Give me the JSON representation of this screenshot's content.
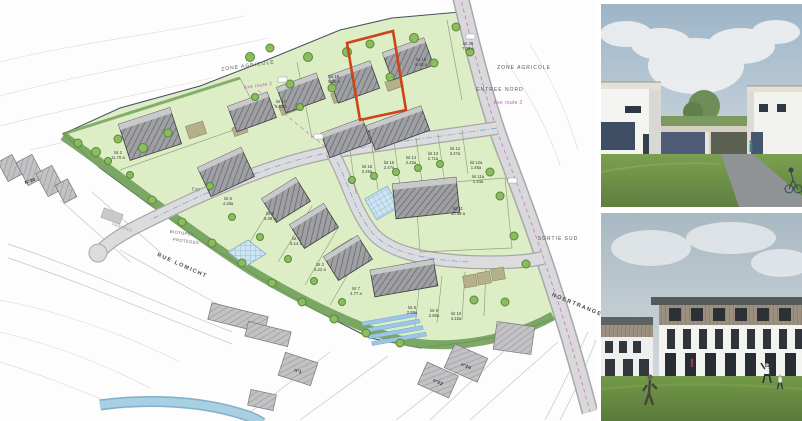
{
  "page": {
    "title": "Plan de lotissement et vues 3D"
  },
  "plan": {
    "texts": {
      "zone_agricole_left": "ZONE AGRICOLE",
      "zone_agricole_right": "ZONE AGRICOLE",
      "entree_nord": "ENTREE NORD",
      "sortie_sud": "SORTIE SUD",
      "axe_route_2": "Axe route 2",
      "axe_route_3": "Axe route 3",
      "rue_lomicht": "RUE LOMICHT",
      "noertrange": "NOERTRANGE>",
      "biotopes_1": "BIOTOPES",
      "biotopes_2": "PROTEGES",
      "parking": "PARKING",
      "esp": "Esp",
      "n30": "N°30",
      "n22": "n°22",
      "n24": "n°24",
      "n1": "n°1"
    },
    "lots": [
      {
        "name": "lot 20",
        "area": "7.02 a"
      },
      {
        "name": "lot 19",
        "area": "6.45 a"
      },
      {
        "name": "lot 18",
        "area": "5.40 a"
      },
      {
        "name": "lot 17",
        "area": "5.63 a"
      },
      {
        "name": "lot 16",
        "area": "2.46a"
      },
      {
        "name": "lot 15",
        "area": "2.47a"
      },
      {
        "name": "lot 14",
        "area": "2.42a"
      },
      {
        "name": "lot 13",
        "area": "2.71a"
      },
      {
        "name": "lot 12",
        "area": "3.47a"
      },
      {
        "name": "lot 12a",
        "area": "1.46a"
      },
      {
        "name": "lot 11a",
        "area": "1.34a"
      },
      {
        "name": "lot 11",
        "area": "10.49 a"
      },
      {
        "name": "lot 10",
        "area": "3.15a"
      },
      {
        "name": "lot 9",
        "area": "2.80a"
      },
      {
        "name": "lot 8",
        "area": "2.59a"
      },
      {
        "name": "lot 7",
        "area": "4.77 a"
      },
      {
        "name": "lot 3",
        "area": "5.22 a"
      },
      {
        "name": "lot 4",
        "area": "5.14 a"
      },
      {
        "name": "lot 5",
        "area": "5.08 a"
      },
      {
        "name": "lot 6",
        "area": "4.28a"
      },
      {
        "name": "lot 2",
        "area": "11.70 a"
      }
    ],
    "colors": {
      "lot_green": "#ddeec6",
      "hedge_green": "#6f9e58",
      "road_gray": "#d9d9db",
      "building_gray": "#9fa0a3",
      "highlight_red": "#cc4418",
      "axis_pink": "#c45cb0",
      "water_blue": "#a9cfe2"
    }
  },
  "renders": {
    "top": {
      "alt": "Vue 3D : maisons unifamiliales blanches à toit plat avec garages et pelouse"
    },
    "bottom": {
      "alt": "Vue 3D : résidences en bande blanches avec attique en bois et pelouse"
    }
  }
}
